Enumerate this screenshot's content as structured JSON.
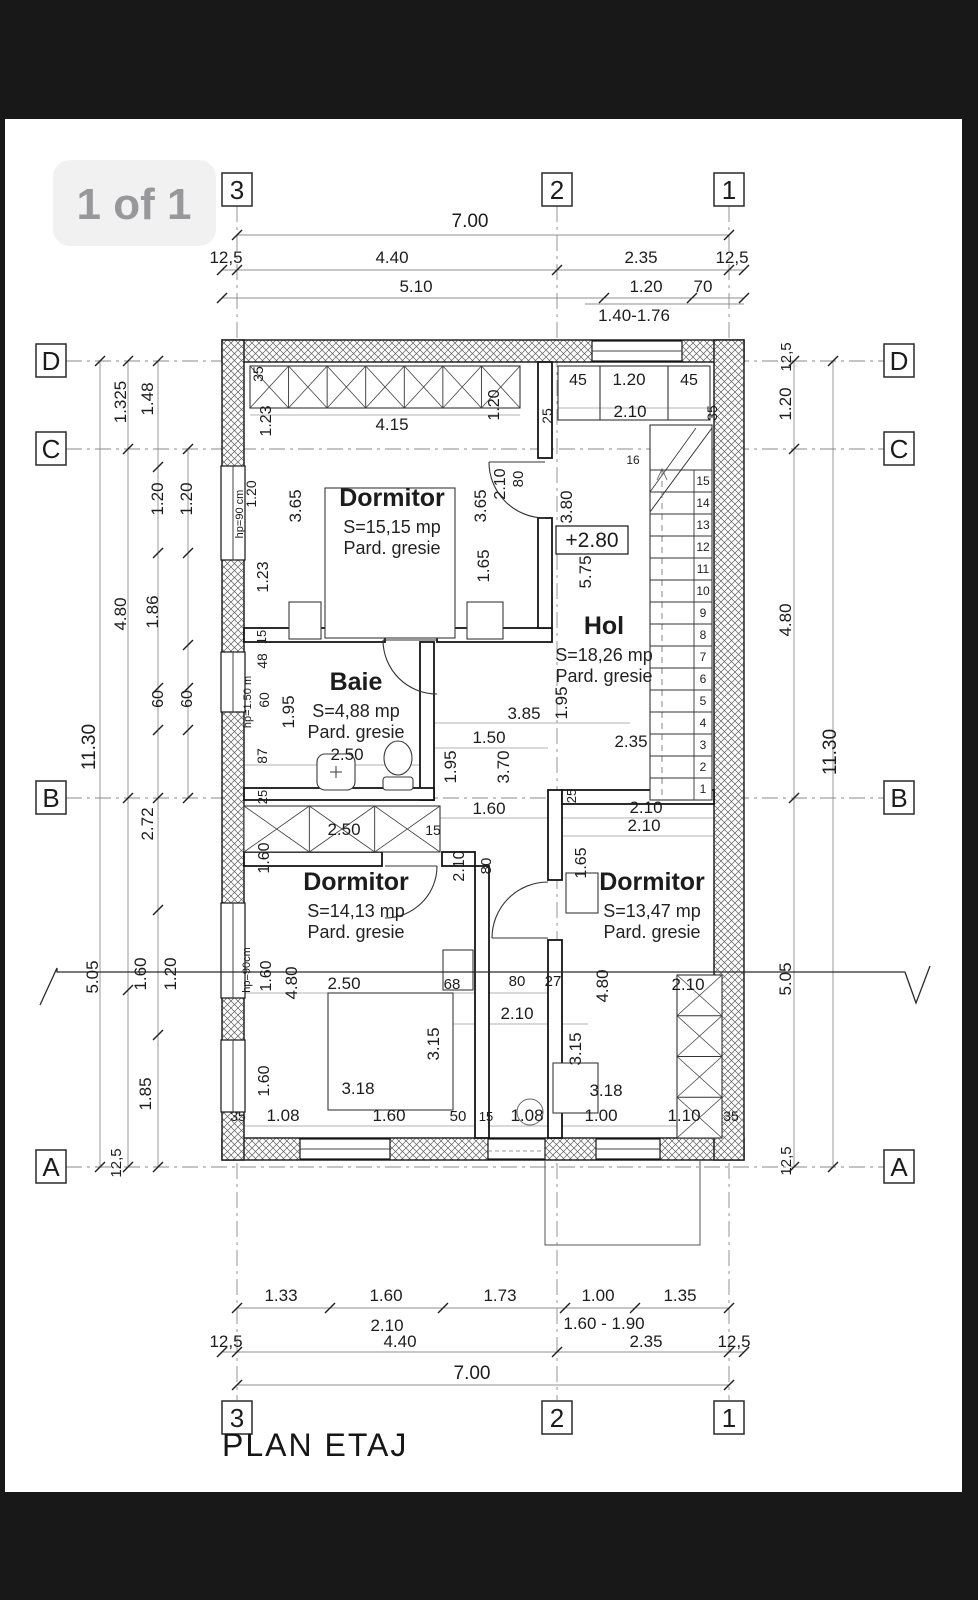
{
  "viewer": {
    "page_indicator": "1 of 1"
  },
  "drawing": {
    "title": "PLAN ETAJ",
    "level_marker": "+2.80"
  },
  "grid": {
    "top": [
      {
        "label": "3",
        "x": 237
      },
      {
        "label": "2",
        "x": 557
      },
      {
        "label": "1",
        "x": 729
      }
    ],
    "bottom": [
      {
        "label": "3",
        "x": 237
      },
      {
        "label": "2",
        "x": 557
      },
      {
        "label": "1",
        "x": 729
      }
    ],
    "left": [
      {
        "label": "D",
        "y": 361
      },
      {
        "label": "C",
        "y": 449
      },
      {
        "label": "B",
        "y": 798
      },
      {
        "label": "A",
        "y": 1167
      }
    ],
    "right": [
      {
        "label": "D",
        "y": 361
      },
      {
        "label": "C",
        "y": 449
      },
      {
        "label": "B",
        "y": 798
      },
      {
        "label": "A",
        "y": 1167
      }
    ]
  },
  "rooms": [
    {
      "name": "Dormitor",
      "area": "S=15,15 mp",
      "floor": "Pard. gresie",
      "x": 392,
      "y": 506
    },
    {
      "name": "Baie",
      "area": "S=4,88 mp",
      "floor": "Pard. gresie",
      "x": 356,
      "y": 690
    },
    {
      "name": "Hol",
      "area": "S=18,26 mp",
      "floor": "Pard. gresie",
      "x": 604,
      "y": 634
    },
    {
      "name": "Dormitor",
      "area": "S=14,13 mp",
      "floor": "Pard. gresie",
      "x": 356,
      "y": 890
    },
    {
      "name": "Dormitor",
      "area": "S=13,47 mp",
      "floor": "Pard. gresie",
      "x": 652,
      "y": 890
    }
  ],
  "stairs": {
    "top_step": "16",
    "steps": [
      "1",
      "2",
      "3",
      "4",
      "5",
      "6",
      "7",
      "8",
      "9",
      "10",
      "11",
      "12",
      "13",
      "14",
      "15"
    ]
  },
  "dims": [
    {
      "t": "7.00",
      "x": 470,
      "y": 227,
      "s": 19
    },
    {
      "t": "12,5",
      "x": 226,
      "y": 263
    },
    {
      "t": "4.40",
      "x": 392,
      "y": 263
    },
    {
      "t": "2.35",
      "x": 641,
      "y": 263
    },
    {
      "t": "12,5",
      "x": 732,
      "y": 263
    },
    {
      "t": "5.10",
      "x": 416,
      "y": 292
    },
    {
      "t": "1.20",
      "x": 646,
      "y": 292
    },
    {
      "t": "70",
      "x": 703,
      "y": 292
    },
    {
      "t": "1.40-1.76",
      "x": 634,
      "y": 321
    },
    {
      "t": "1.33",
      "x": 281,
      "y": 1301
    },
    {
      "t": "1.60",
      "x": 386,
      "y": 1301
    },
    {
      "t": "1.73",
      "x": 500,
      "y": 1301
    },
    {
      "t": "1.00",
      "x": 598,
      "y": 1301
    },
    {
      "t": "1.35",
      "x": 680,
      "y": 1301
    },
    {
      "t": "2.10",
      "x": 387,
      "y": 1331
    },
    {
      "t": "1.60 - 1.90",
      "x": 604,
      "y": 1329
    },
    {
      "t": "12,5",
      "x": 226,
      "y": 1347
    },
    {
      "t": "4.40",
      "x": 400,
      "y": 1347
    },
    {
      "t": "2.35",
      "x": 646,
      "y": 1347
    },
    {
      "t": "12,5",
      "x": 734,
      "y": 1347
    },
    {
      "t": "7.00",
      "x": 472,
      "y": 1379,
      "s": 19
    },
    {
      "t": "11.30",
      "x": 95,
      "y": 747,
      "r": -90,
      "s": 19
    },
    {
      "t": "5.05",
      "x": 98,
      "y": 977,
      "r": -90
    },
    {
      "t": "1.325",
      "x": 126,
      "y": 402,
      "r": -90
    },
    {
      "t": "4.80",
      "x": 126,
      "y": 614,
      "r": -90
    },
    {
      "t": "2.72",
      "x": 153,
      "y": 824,
      "r": -90
    },
    {
      "t": "1.85",
      "x": 151,
      "y": 1094,
      "r": -90
    },
    {
      "t": "12,5",
      "x": 121,
      "y": 1163,
      "r": -90,
      "s": 15
    },
    {
      "t": "1.48",
      "x": 153,
      "y": 399,
      "r": -90
    },
    {
      "t": "1.86",
      "x": 158,
      "y": 612,
      "r": -90
    },
    {
      "t": "1.60",
      "x": 146,
      "y": 974,
      "r": -90
    },
    {
      "t": "1.20",
      "x": 163,
      "y": 499,
      "r": -90
    },
    {
      "t": "1.20",
      "x": 192,
      "y": 499,
      "r": -90
    },
    {
      "t": "60",
      "x": 163,
      "y": 699,
      "r": -90,
      "s": 16
    },
    {
      "t": "60",
      "x": 192,
      "y": 699,
      "r": -90,
      "s": 16
    },
    {
      "t": "1.20",
      "x": 176,
      "y": 974,
      "r": -90
    },
    {
      "t": "12,5",
      "x": 791,
      "y": 357,
      "r": -90,
      "s": 15
    },
    {
      "t": "1.20",
      "x": 791,
      "y": 404,
      "r": -90
    },
    {
      "t": "4.80",
      "x": 791,
      "y": 620,
      "r": -90
    },
    {
      "t": "5.05",
      "x": 791,
      "y": 979,
      "r": -90
    },
    {
      "t": "12,5",
      "x": 791,
      "y": 1161,
      "r": -90,
      "s": 15
    },
    {
      "t": "11.30",
      "x": 836,
      "y": 752,
      "r": -90,
      "s": 19
    },
    {
      "t": "35",
      "x": 263,
      "y": 374,
      "r": -90,
      "s": 14
    },
    {
      "t": "1.23",
      "x": 271,
      "y": 421,
      "r": -90,
      "s": 16
    },
    {
      "t": "4.15",
      "x": 392,
      "y": 430
    },
    {
      "t": "1.20",
      "x": 499,
      "y": 405,
      "r": -90,
      "s": 16
    },
    {
      "t": "25",
      "x": 552,
      "y": 416,
      "r": -90,
      "s": 14
    },
    {
      "t": "45",
      "x": 578,
      "y": 385,
      "s": 16
    },
    {
      "t": "1.20",
      "x": 629,
      "y": 385
    },
    {
      "t": "45",
      "x": 689,
      "y": 385,
      "s": 16
    },
    {
      "t": "2.10",
      "x": 630,
      "y": 417
    },
    {
      "t": "35",
      "x": 717,
      "y": 413,
      "r": -90,
      "s": 14
    },
    {
      "t": "3.65",
      "x": 301,
      "y": 506,
      "r": -90
    },
    {
      "t": "3.65",
      "x": 486,
      "y": 506,
      "r": -90
    },
    {
      "t": "2.10",
      "x": 505,
      "y": 484,
      "r": -90,
      "s": 16
    },
    {
      "t": "80",
      "x": 523,
      "y": 479,
      "r": -90,
      "s": 15
    },
    {
      "t": "3.80",
      "x": 572,
      "y": 507,
      "r": -90
    },
    {
      "t": "1.20",
      "x": 256,
      "y": 494,
      "r": -90,
      "s": 14
    },
    {
      "t": "hp=90 cm",
      "x": 243,
      "y": 514,
      "r": -90,
      "s": 11
    },
    {
      "t": "1.23",
      "x": 268,
      "y": 577,
      "r": -90,
      "s": 16
    },
    {
      "t": "1.65",
      "x": 489,
      "y": 566,
      "r": -90
    },
    {
      "t": "5.75",
      "x": 591,
      "y": 572,
      "r": -90
    },
    {
      "t": "15",
      "x": 266,
      "y": 637,
      "r": -90,
      "s": 13
    },
    {
      "t": "48",
      "x": 267,
      "y": 661,
      "r": -90,
      "s": 14
    },
    {
      "t": "60",
      "x": 269,
      "y": 700,
      "r": -90,
      "s": 14
    },
    {
      "t": "hp=1.50 m",
      "x": 251,
      "y": 702,
      "r": -90,
      "s": 11
    },
    {
      "t": "87",
      "x": 267,
      "y": 756,
      "r": -90,
      "s": 14
    },
    {
      "t": "25",
      "x": 267,
      "y": 797,
      "r": -90,
      "s": 13
    },
    {
      "t": "1.95",
      "x": 294,
      "y": 712,
      "r": -90
    },
    {
      "t": "2.50",
      "x": 347,
      "y": 760
    },
    {
      "t": "2.50",
      "x": 344,
      "y": 835
    },
    {
      "t": "15",
      "x": 433,
      "y": 835,
      "s": 14
    },
    {
      "t": "1.60",
      "x": 269,
      "y": 858,
      "r": -90,
      "s": 16
    },
    {
      "t": "1.95",
      "x": 567,
      "y": 703,
      "r": -90
    },
    {
      "t": "3.85",
      "x": 524,
      "y": 719
    },
    {
      "t": "2.35",
      "x": 631,
      "y": 747
    },
    {
      "t": "1.50",
      "x": 489,
      "y": 743
    },
    {
      "t": "3.70",
      "x": 509,
      "y": 767,
      "r": -90
    },
    {
      "t": "1.95",
      "x": 456,
      "y": 767,
      "r": -90
    },
    {
      "t": "1.60",
      "x": 489,
      "y": 814
    },
    {
      "t": "2.10",
      "x": 646,
      "y": 813
    },
    {
      "t": "25",
      "x": 576,
      "y": 796,
      "r": -90,
      "s": 13
    },
    {
      "t": "80",
      "x": 491,
      "y": 866,
      "r": -90,
      "s": 15
    },
    {
      "t": "2.10",
      "x": 464,
      "y": 866,
      "r": -90,
      "s": 16
    },
    {
      "t": "1.65",
      "x": 586,
      "y": 863,
      "r": -90,
      "s": 16
    },
    {
      "t": "2.50",
      "x": 344,
      "y": 989
    },
    {
      "t": "68",
      "x": 452,
      "y": 989,
      "s": 15
    },
    {
      "t": "80",
      "x": 517,
      "y": 986,
      "s": 15
    },
    {
      "t": "27",
      "x": 553,
      "y": 986,
      "s": 15
    },
    {
      "t": "4.80",
      "x": 297,
      "y": 983,
      "r": -90
    },
    {
      "t": "1.60",
      "x": 271,
      "y": 976,
      "r": -90,
      "s": 16
    },
    {
      "t": "hp=90cm",
      "x": 250,
      "y": 970,
      "r": -90,
      "s": 11
    },
    {
      "t": "2.10",
      "x": 517,
      "y": 1019
    },
    {
      "t": "3.15",
      "x": 439,
      "y": 1044,
      "r": -90
    },
    {
      "t": "3.18",
      "x": 358,
      "y": 1094
    },
    {
      "t": "1.08",
      "x": 283,
      "y": 1121
    },
    {
      "t": "1.60",
      "x": 389,
      "y": 1121
    },
    {
      "t": "50",
      "x": 458,
      "y": 1121,
      "s": 15
    },
    {
      "t": "15",
      "x": 486,
      "y": 1121,
      "s": 13
    },
    {
      "t": "1.08",
      "x": 527,
      "y": 1121
    },
    {
      "t": "35",
      "x": 238,
      "y": 1121,
      "s": 14
    },
    {
      "t": "1.60",
      "x": 269,
      "y": 1081,
      "r": -90,
      "s": 16
    },
    {
      "t": "2.10",
      "x": 644,
      "y": 831
    },
    {
      "t": "4.80",
      "x": 608,
      "y": 986,
      "r": -90
    },
    {
      "t": "2.10",
      "x": 688,
      "y": 990
    },
    {
      "t": "3.15",
      "x": 581,
      "y": 1049,
      "r": -90
    },
    {
      "t": "3.18",
      "x": 606,
      "y": 1096
    },
    {
      "t": "1.00",
      "x": 601,
      "y": 1121
    },
    {
      "t": "1.10",
      "x": 684,
      "y": 1121
    },
    {
      "t": "35",
      "x": 731,
      "y": 1121,
      "s": 14
    }
  ]
}
